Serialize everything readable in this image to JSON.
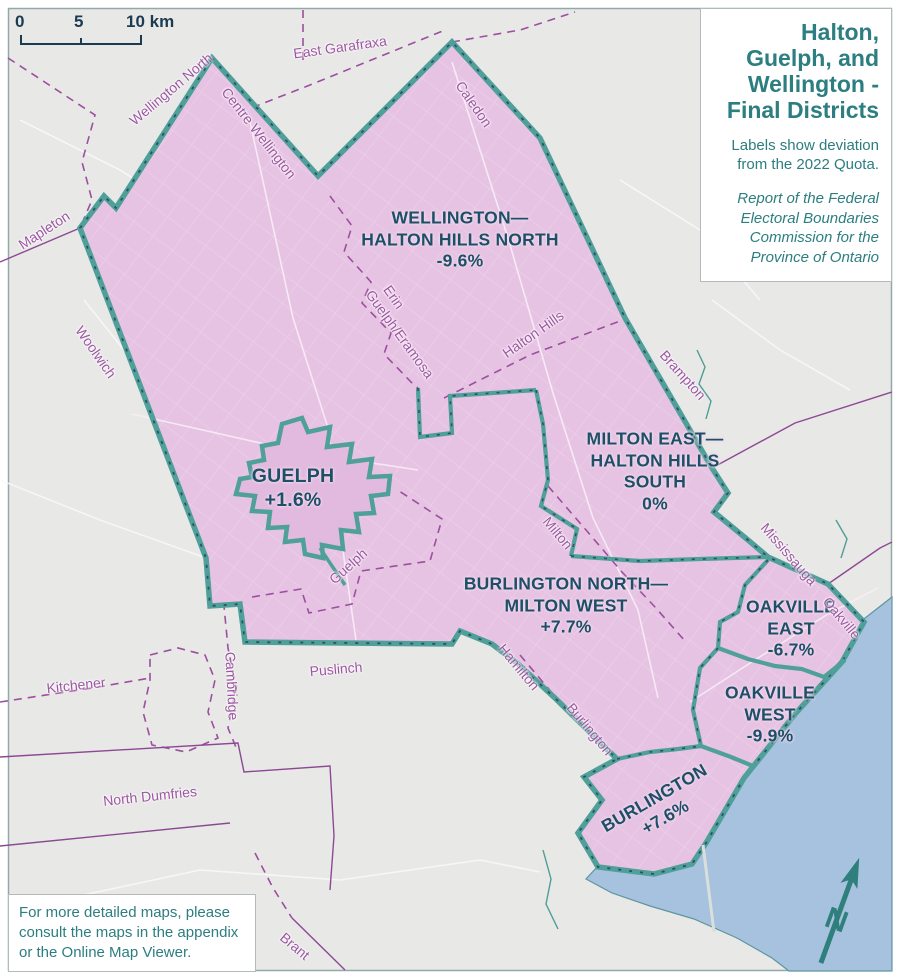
{
  "map_title_box": {
    "title": "Halton, Guelph, and Wellington - Final Districts",
    "subtitle": "Labels show deviation from the 2022 Quota.",
    "citation": "Report of the Federal Electoral Boundaries Commission for the Province of Ontario"
  },
  "scale_bar": {
    "zero": "0",
    "five": "5",
    "ten": "10 km"
  },
  "note_box": {
    "text": "For more detailed maps, please consult the maps in the appendix or the Online Map Viewer."
  },
  "districts": {
    "wellington_halton_hills_north": {
      "line1": "WELLINGTON—",
      "line2": "HALTON HILLS NORTH",
      "deviation": "-9.6%"
    },
    "guelph": {
      "name": "GUELPH",
      "deviation": "+1.6%"
    },
    "milton_east_halton_hills_south": {
      "line1": "MILTON EAST—",
      "line2": "HALTON HILLS",
      "line3": "SOUTH",
      "deviation": "0%"
    },
    "burlington_north_milton_west": {
      "line1": "BURLINGTON NORTH—",
      "line2": "MILTON WEST",
      "deviation": "+7.7%"
    },
    "oakville_east": {
      "line1": "OAKVILLE",
      "line2": "EAST",
      "deviation": "-6.7%"
    },
    "oakville_west": {
      "line1": "OAKVILLE",
      "line2": "WEST",
      "deviation": "-9.9%"
    },
    "burlington": {
      "name": "BURLINGTON",
      "deviation": "+7.6%"
    }
  },
  "municipalities": {
    "east_garafraxa": "East Garafraxa",
    "caledon": "Caledon",
    "wellington_north": "Wellington North",
    "centre_wellington": "Centre Wellington",
    "mapleton": "Mapleton",
    "woolwich": "Woolwich",
    "erin": "Erin",
    "guelph_eramosa": "Guelph/Eramosa",
    "halton_hills": "Halton Hills",
    "brampton": "Brampton",
    "milton": "Milton",
    "mississauga": "Mississauga",
    "oakville": "Oakville",
    "guelph_city": "Guelph",
    "puslinch": "Puslinch",
    "cambridge": "Cambridge",
    "kitchener": "Kitchener",
    "hamilton": "Hamilton",
    "burlington_muni": "Burlington",
    "north_dumfries": "North Dumfries",
    "brant": "Brant"
  },
  "compass": {
    "label": "N"
  },
  "colors": {
    "district_fill": "#e7c3e3",
    "guelph_city_fill": "#e2badf",
    "boundary_teal": "#4fa099",
    "boundary_dash_navy": "#2f4f68",
    "municipal_purple": "#9b4f9e",
    "lake_blue": "#a6c2df",
    "land_grey": "#e8e8e7",
    "district_label_navy": "#1d4f66",
    "municipality_label_purple": "#9d57a2",
    "title_teal": "#2c7e80"
  }
}
